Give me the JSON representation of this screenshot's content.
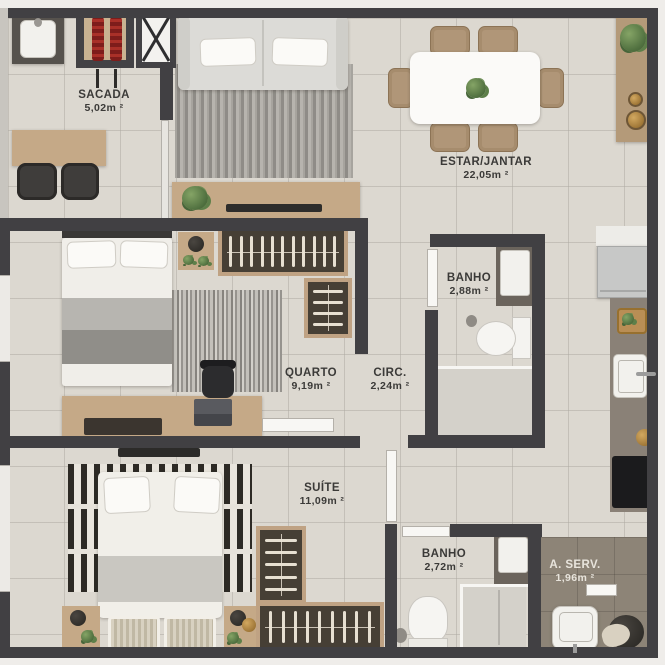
{
  "plan": {
    "title": "Apartment floor plan",
    "rooms": [
      {
        "name": "SACADA",
        "area": "5,02m ²"
      },
      {
        "name": "ESTAR/JANTAR",
        "area": "22,05m ²"
      },
      {
        "name": "BANHO",
        "area": "2,88m ²"
      },
      {
        "name": "QUARTO",
        "area": "9,19m ²"
      },
      {
        "name": "CIRC.",
        "area": "2,24m ²"
      },
      {
        "name": "SUÍTE",
        "area": "11,09m ²"
      },
      {
        "name": "BANHO",
        "area": "2,72m ²"
      },
      {
        "name": "A. SERV.",
        "area": "1,96m ²"
      }
    ],
    "colors": {
      "wall": "#414043",
      "floor": "#dcd8d0",
      "service_floor": "#8d8477",
      "wood": "#c5a987",
      "closet_interior": "#46423a",
      "grill_red": "#8e2320",
      "plant_green": "#5d7f49",
      "counter_dark": "#8a8177",
      "stove_black": "#1b1b1d",
      "label_text": "#3b3a38"
    },
    "furniture": [
      "balcony sink counter",
      "barbecue grill with skewers",
      "duct shaft",
      "balcony table with two chairs",
      "sofa",
      "living rug",
      "tv console with plant",
      "dining table with centerpiece and six chairs",
      "sideboard with plant and bowls",
      "fridge",
      "kitchen counter",
      "cutting board",
      "kitchen sink",
      "cooktop",
      "double bed",
      "nightstand",
      "wardrobe with hangers",
      "desk with chair and laptop",
      "toilet",
      "bathroom vanity",
      "shower",
      "suite bed",
      "striped rug",
      "wicker benches",
      "l-shaped wardrobe",
      "laundry tank",
      "laundry basket"
    ]
  }
}
